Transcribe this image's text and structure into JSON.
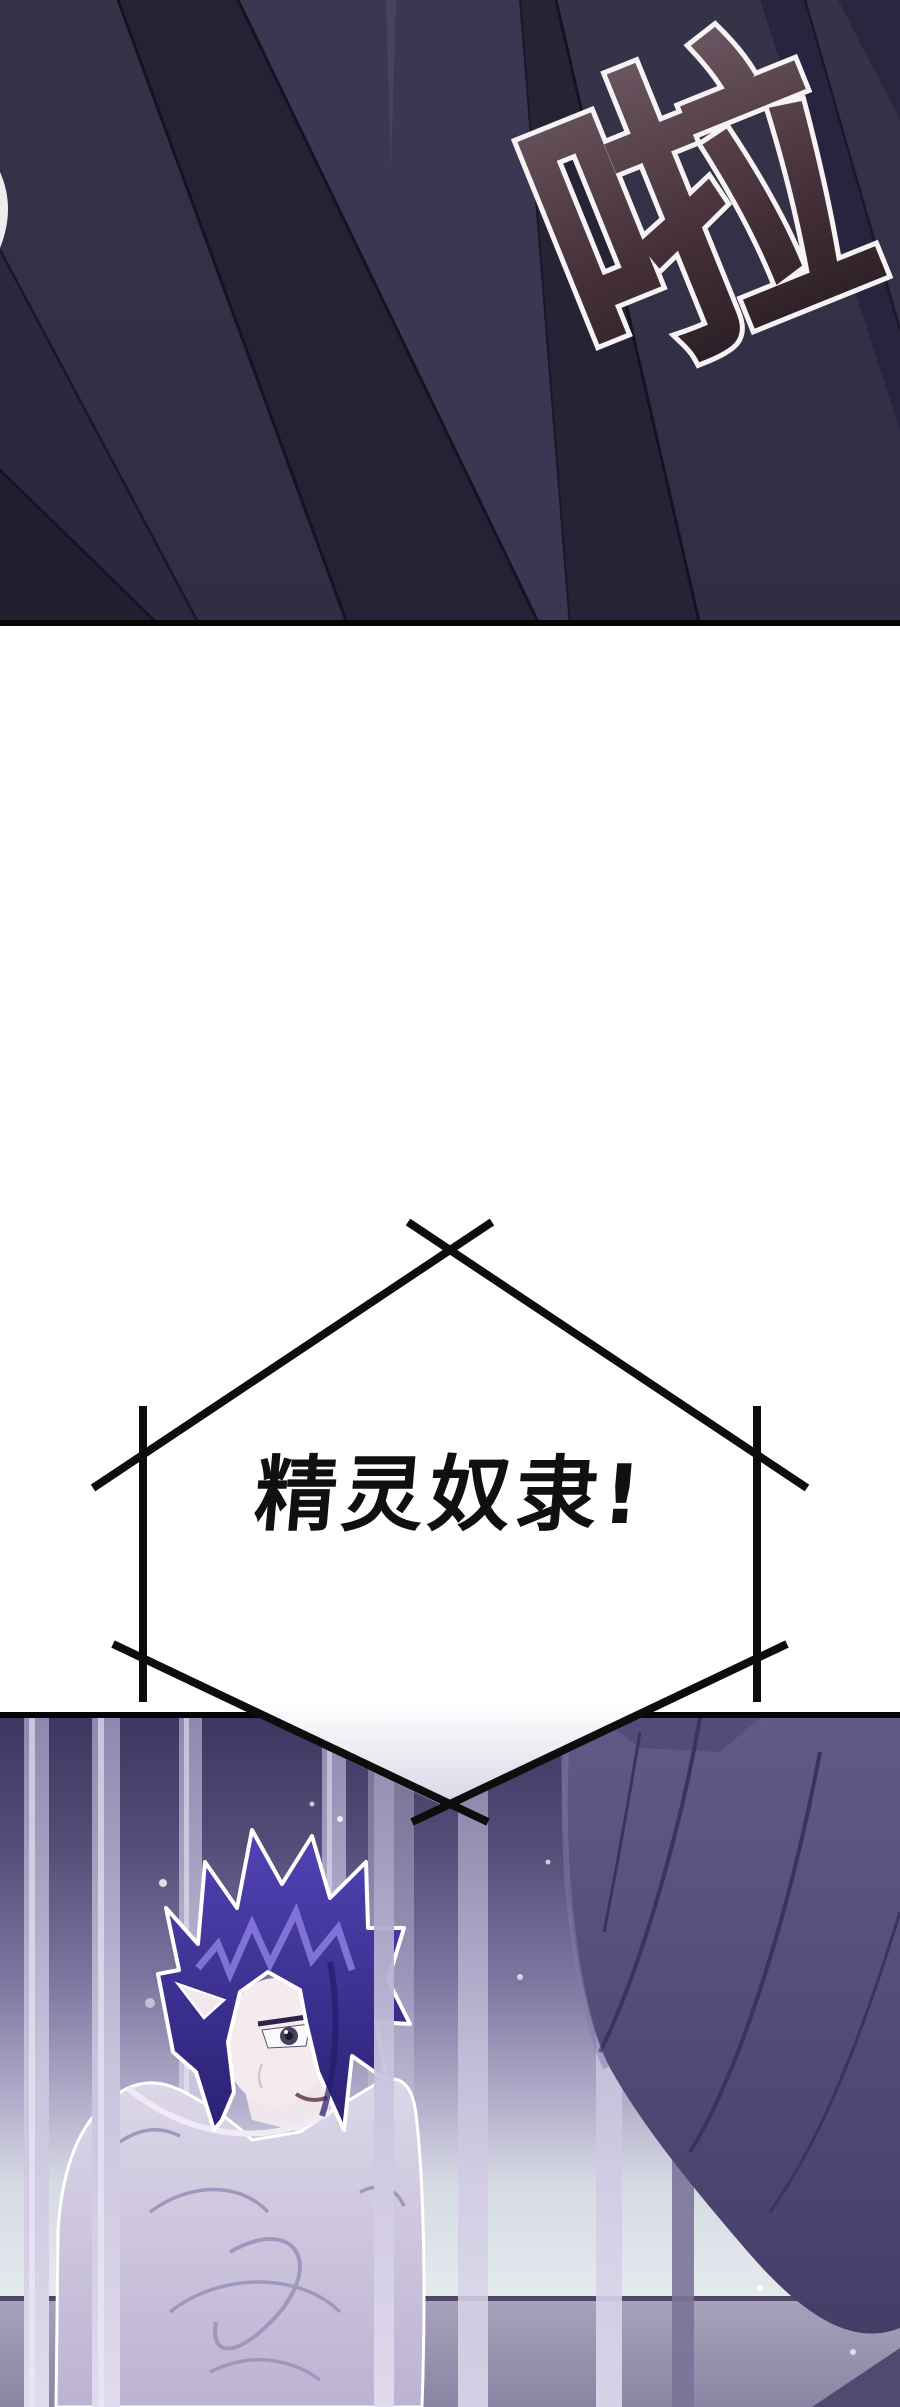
{
  "page": {
    "type": "webtoon comic page",
    "background": "#ffffff"
  },
  "top_panel": {
    "description": "extreme close-up of a dark navy hooded cloak with angular fabric folds",
    "border_color": "#000000",
    "base_color": "#332f47",
    "sfx": {
      "text": "啦",
      "style": "large tilted comic sound-effect glyph",
      "fill_top": "#6e5a64",
      "fill_bottom": "#241a21",
      "outline": "#f5f3f4"
    }
  },
  "speech_bubble": {
    "shape": "hexagonal burst with crossed corner strokes",
    "text": "精灵奴隶!",
    "text_color": "#101010",
    "line_color": "#0d0d0d",
    "fill": "#ffffff",
    "notch_tint": "#d9d5e6"
  },
  "bottom_panel": {
    "description": "elf prisoner with spiky indigo hair slouching behind cage bars; dark cloaked figure looms in right foreground; sparkle motes in the air",
    "border_color": "#000000",
    "colors": {
      "background_top": "#3d3660",
      "background_bottom": "#e4ebee",
      "cage_bar": "#c9c2dd",
      "cage_bar_shadow": "#7b7398",
      "hair": "#4334a5",
      "hair_highlight": "#8b7ce0",
      "skin": "#f2eaee",
      "robe": "#d6d0e2",
      "cloak": "#564e7e",
      "wall": "#968fae",
      "sparkle": "#ffffff"
    }
  }
}
